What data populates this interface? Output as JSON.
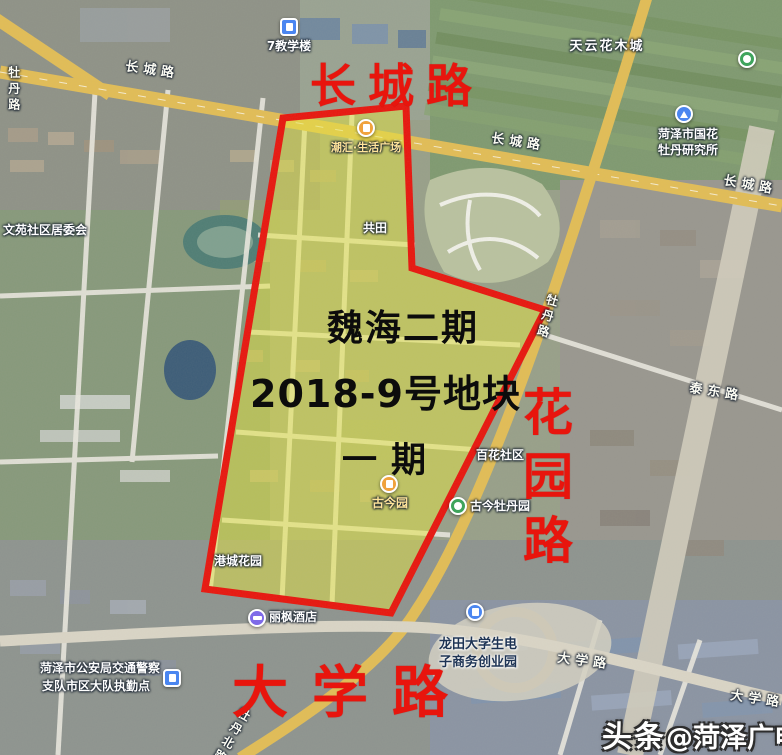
{
  "annotations": {
    "parcel": {
      "line1": "魏海二期",
      "line2": "2018-9号地块",
      "line3": "一期"
    },
    "roads_big": {
      "north": "长城路",
      "east": "花园路",
      "south": "大学路"
    },
    "colors": {
      "boundary": "#e8150d",
      "highlight": "#e6e63c",
      "big_road_text": "#e8150d",
      "parcel_text": "#0c0c0c"
    }
  },
  "map": {
    "road_labels": [
      {
        "text": "长城路"
      },
      {
        "text": "长城路"
      },
      {
        "text": "长城路"
      },
      {
        "text": "牡丹路"
      },
      {
        "text": "牡丹路"
      },
      {
        "text": "泰东路"
      },
      {
        "text": "大学路"
      },
      {
        "text": "大学路"
      },
      {
        "text": "牡丹北路"
      }
    ],
    "pois": [
      {
        "text": "7教学楼",
        "icon": "school-building"
      },
      {
        "text": "天云花木城"
      },
      {
        "text": "文苑社区居委会"
      },
      {
        "text": "菏泽市国花",
        "text2": "牡丹研究所",
        "icon": "research"
      },
      {
        "text": "潮汇·生活广场",
        "icon": "mall"
      },
      {
        "text": "共田"
      },
      {
        "text": "百花社区"
      },
      {
        "text": "古今园",
        "icon": "garden"
      },
      {
        "text": "古今牡丹园",
        "icon": "park"
      },
      {
        "text": "港城花园"
      },
      {
        "text": "丽枫酒店",
        "icon": "hotel"
      },
      {
        "text": "菏泽市公安局交通警察",
        "text2": "支队市区大队执勤点",
        "icon": "police"
      },
      {
        "text": "龙田大学生电",
        "text2": "子商务创业园",
        "icon": "company"
      }
    ]
  },
  "watermark": {
    "brand": "头条",
    "handle": "@菏泽广电网"
  }
}
